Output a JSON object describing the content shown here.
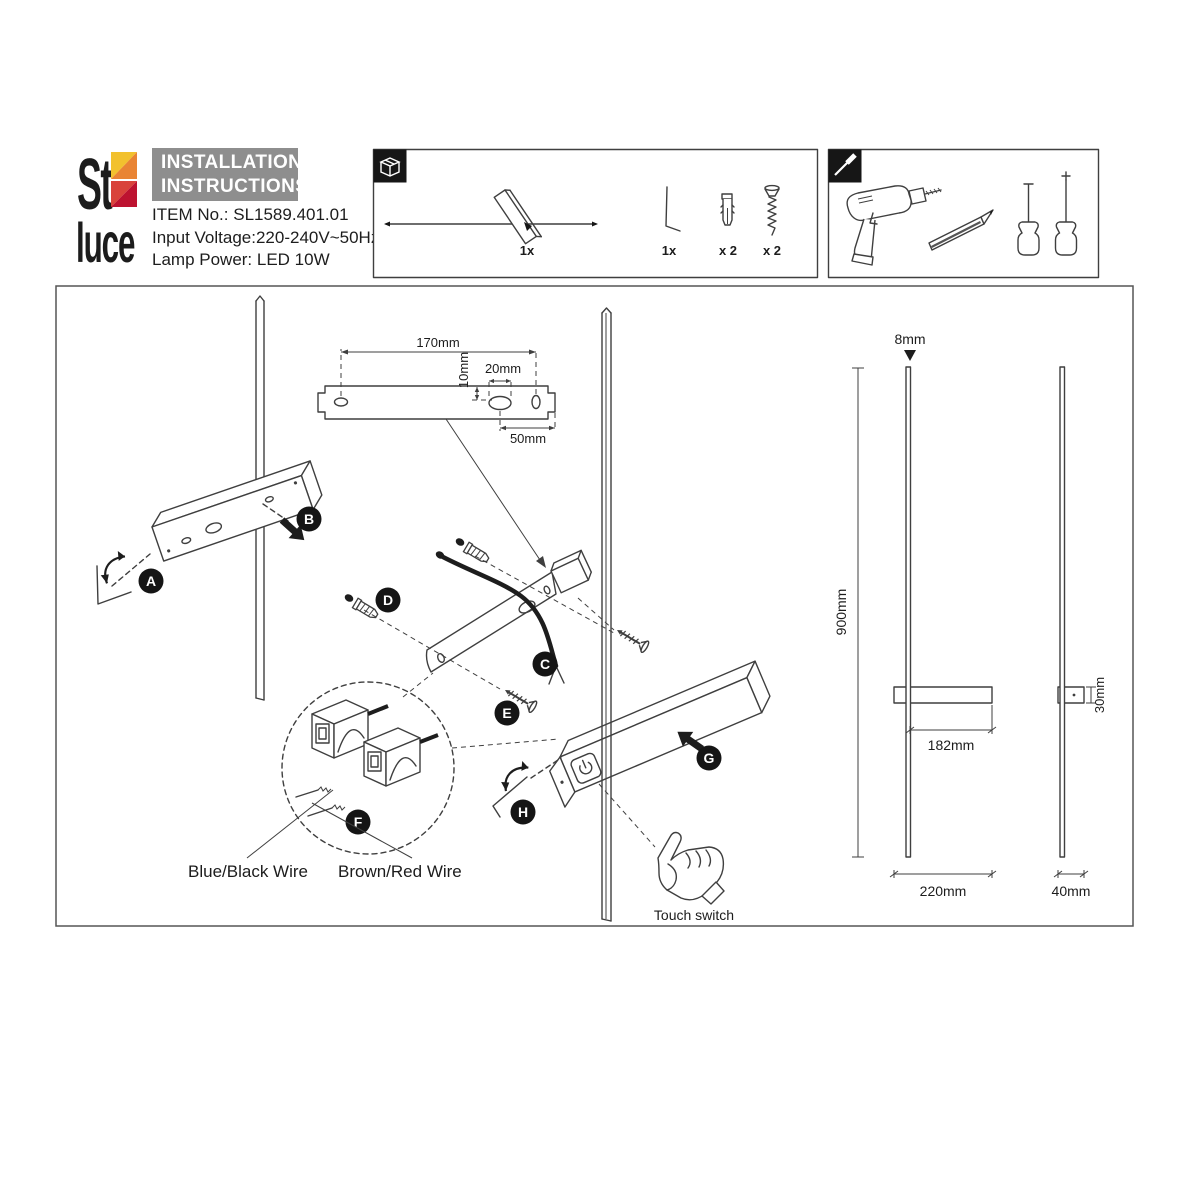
{
  "header": {
    "title_line1": "INSTALLATION",
    "title_line2": "INSTRUCTIONS",
    "item_no": "ITEM No.: SL1589.401.01",
    "input_voltage": "Input Voltage:220-240V~50Hz",
    "lamp_power": "Lamp Power: LED 10W"
  },
  "logo": {
    "top": "St",
    "bottom": "luce"
  },
  "package_box": {
    "lamp_qty": "1x",
    "hex_key_qty": "1x",
    "wall_plug_qty": "x 2",
    "screw_qty": "x 2"
  },
  "bracket_dims": {
    "length": "170mm",
    "hole_offset": "10mm",
    "slot_width": "20mm",
    "slot_to_end": "50mm"
  },
  "steps": {
    "a": "A",
    "b": "B",
    "c": "C",
    "d": "D",
    "e": "E",
    "f": "F",
    "g": "G",
    "h": "H"
  },
  "wire_labels": {
    "blue_black": "Blue/Black Wire",
    "brown_red": "Brown/Red Wire"
  },
  "touch_switch_label": "Touch switch",
  "front_view": {
    "height": "900mm",
    "rod_diameter": "8mm",
    "body_to_end": "182mm",
    "body_width": "220mm"
  },
  "side_view": {
    "body_height": "30mm",
    "body_depth": "40mm"
  },
  "colors": {
    "logo_yellow": "#F2C12E",
    "logo_orange": "#E98434",
    "logo_red": "#D9433B",
    "logo_crimson": "#BD1330",
    "header_gray": "#8E8E8E",
    "line": "#3f3f3f",
    "ink": "#1c1c1c"
  }
}
